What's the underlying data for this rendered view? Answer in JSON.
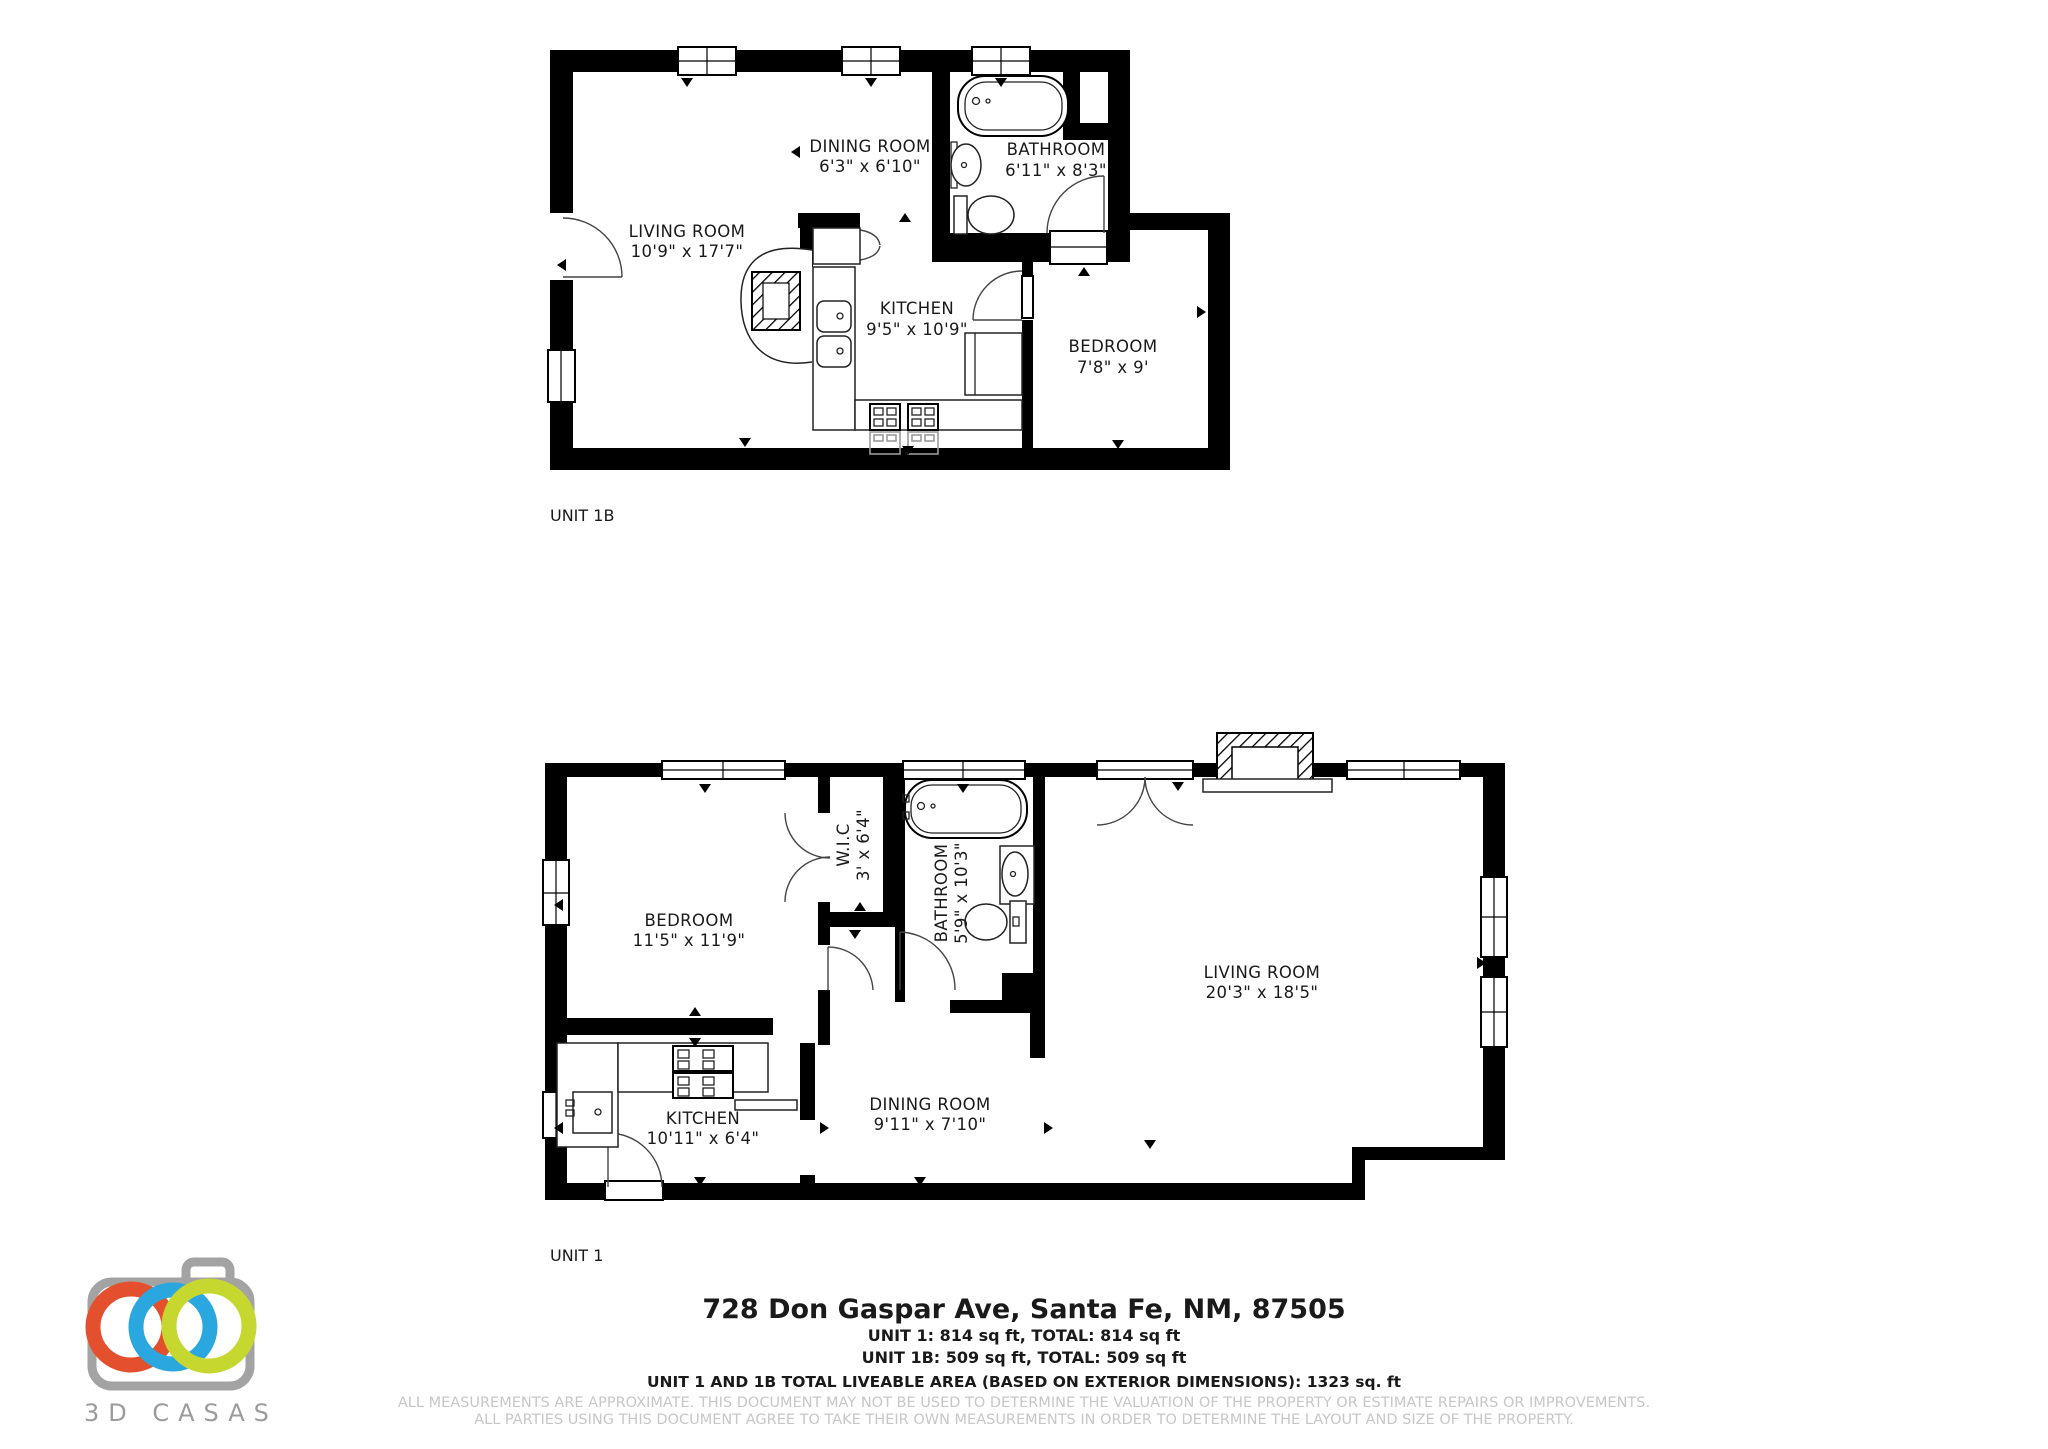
{
  "document_type": "floor-plan",
  "plans": {
    "unit_1b": {
      "caption": "UNIT 1B",
      "rooms": [
        {
          "name": "LIVING ROOM",
          "dims": "10'9\" x 17'7\""
        },
        {
          "name": "DINING ROOM",
          "dims": "6'3\" x 6'10\""
        },
        {
          "name": "KITCHEN",
          "dims": "9'5\" x 10'9\""
        },
        {
          "name": "BATHROOM",
          "dims": "6'11\" x 8'3\""
        },
        {
          "name": "BEDROOM",
          "dims": "7'8\" x 9'"
        }
      ]
    },
    "unit_1": {
      "caption": "UNIT 1",
      "rooms": [
        {
          "name": "BEDROOM",
          "dims": "11'5\" x 11'9\""
        },
        {
          "name": "W.I.C",
          "dims": "3' x 6'4\""
        },
        {
          "name": "BATHROOM",
          "dims": "5'9\" x 10'3\""
        },
        {
          "name": "LIVING ROOM",
          "dims": "20'3\" x 18'5\""
        },
        {
          "name": "KITCHEN",
          "dims": "10'11\" x 6'4\""
        },
        {
          "name": "DINING ROOM",
          "dims": "9'11\" x 7'10\""
        }
      ]
    }
  },
  "footer": {
    "address": "728 Don Gaspar Ave, Santa Fe, NM, 87505",
    "unit1_area": "UNIT 1: 814 sq ft, TOTAL: 814 sq ft",
    "unit1b_area": "UNIT 1B: 509 sq ft, TOTAL: 509 sq ft",
    "total_area": "UNIT 1 AND 1B TOTAL LIVEABLE AREA (BASED ON EXTERIOR DIMENSIONS): 1323 sq. ft",
    "disclaimer_line1": "ALL MEASUREMENTS ARE APPROXIMATE. THIS DOCUMENT MAY NOT BE USED TO DETERMINE THE VALUATION OF THE PROPERTY OR ESTIMATE REPAIRS OR IMPROVEMENTS.",
    "disclaimer_line2": "ALL PARTIES USING THIS DOCUMENT AGREE TO TAKE THEIR OWN MEASUREMENTS IN ORDER TO DETERMINE THE LAYOUT AND SIZE OF THE PROPERTY."
  },
  "logo": {
    "brand": "3D CASAS",
    "colors": {
      "camera_outline": "#a3a3a3",
      "ring_orange": "#e4502d",
      "ring_blue": "#2aa7df",
      "ring_green": "#c6d82f",
      "brand_text": "#9b9b9b"
    }
  },
  "style": {
    "wall_color": "#000000",
    "background": "#ffffff",
    "label_color": "#1a1a1a",
    "disclaimer_color": "#c7c7c7"
  }
}
